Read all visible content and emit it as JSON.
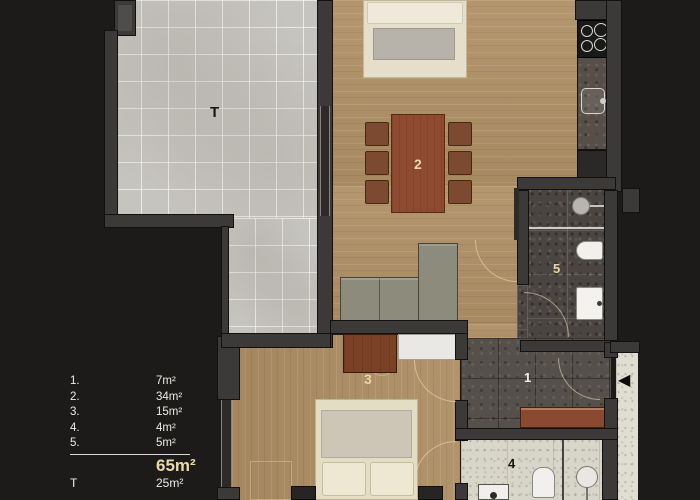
{
  "legend": {
    "rows": [
      {
        "num": "1.",
        "area": "7m²"
      },
      {
        "num": "2.",
        "area": "34m²"
      },
      {
        "num": "3.",
        "area": "15m²"
      },
      {
        "num": "4.",
        "area": "4m²"
      },
      {
        "num": "5.",
        "area": "5m²"
      }
    ],
    "total_area": "65m²",
    "terrace": {
      "num": "T",
      "area": "25m²"
    }
  },
  "plan": {
    "labels": {
      "terrace": "T",
      "living_dining": "2",
      "bedroom": "3",
      "hall": "1",
      "wc": "4",
      "bathroom": "5"
    }
  },
  "icons": {
    "entry_arrow": "◀"
  },
  "colors": {
    "background": "#1c1b19",
    "wall": "#3b3a38",
    "wood_floor": "#b09166",
    "terrace_tile": "#c6c4be",
    "hall_tile": "#55504a",
    "bath_tile": "#4a4540",
    "light_tile": "#d8d5c9",
    "table_wood": "#8e4b31",
    "label_cream": "#e9d8a4",
    "label_white": "#f0efed"
  }
}
